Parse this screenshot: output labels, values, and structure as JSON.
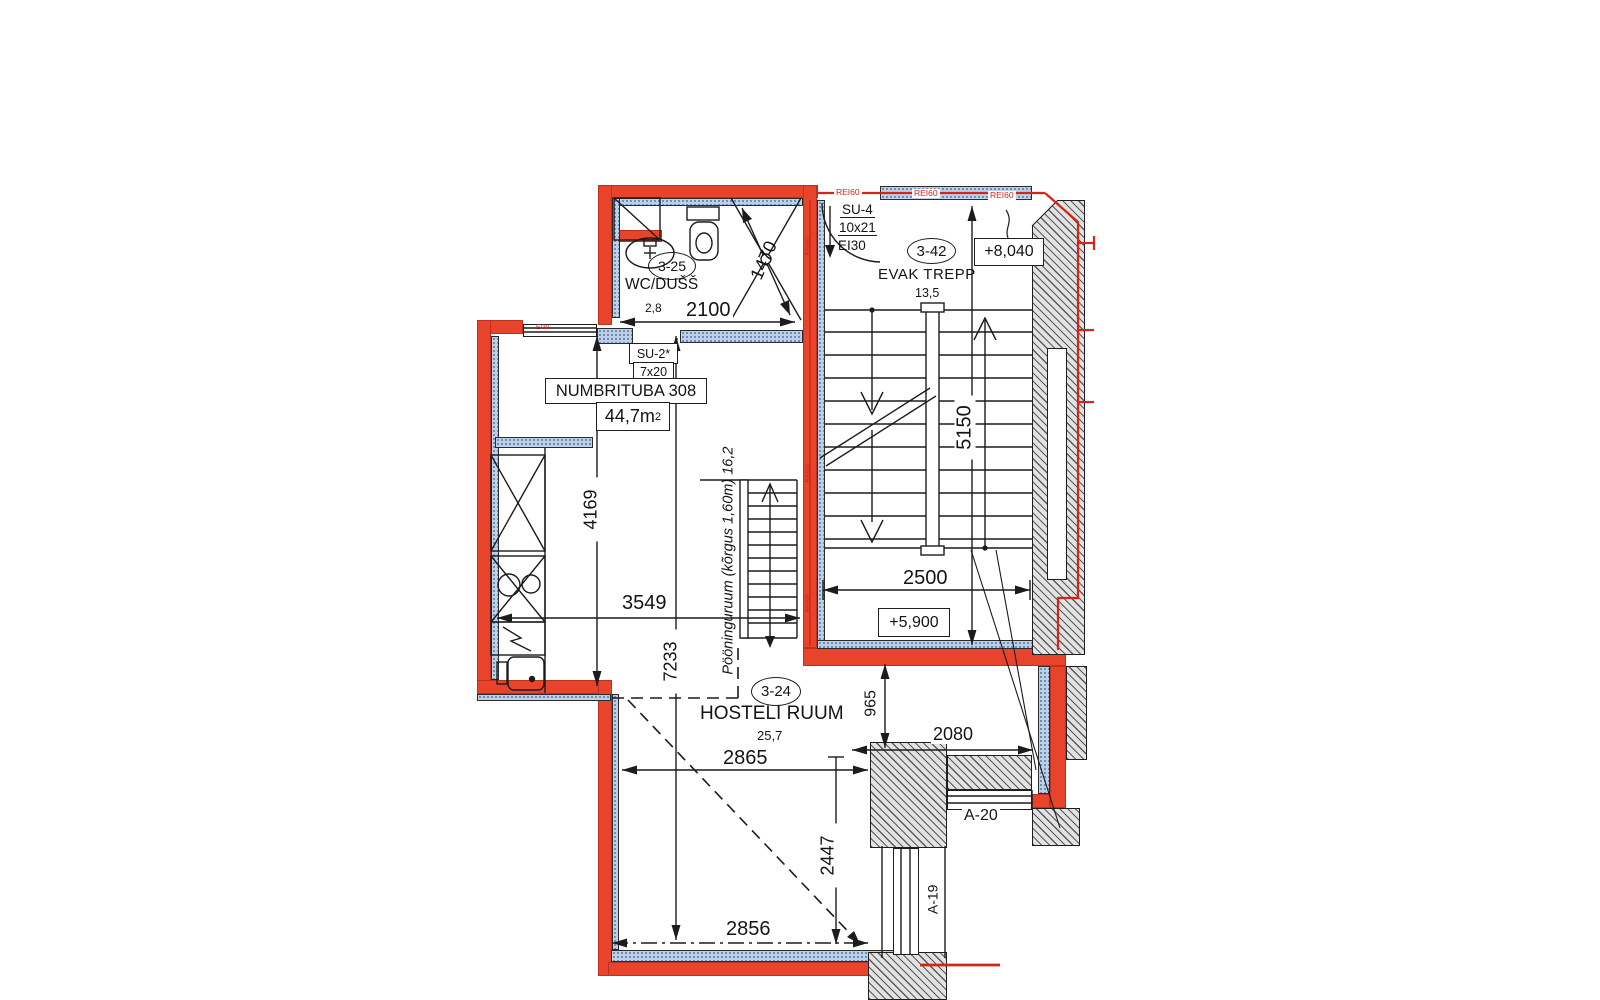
{
  "colors": {
    "wall": "#e8432b",
    "fire": "#d3261a",
    "hatch_blue": "#bcd0ea",
    "hatch_gray": "#e2e2e2",
    "line": "#1c1c1c"
  },
  "rooms": {
    "wc": {
      "id": "3-25",
      "name": "WC/DUŠŠ",
      "area": "2,8"
    },
    "guest": {
      "name": "NUMBRITUBA 308",
      "area_value": "44,7m",
      "area_sup": "2"
    },
    "stair": {
      "id": "3-42",
      "name": "EVAK TREPP",
      "area": "13,5"
    },
    "hostel": {
      "id": "3-24",
      "name": "HOSTELI RUUM",
      "area": "25,7"
    },
    "attic": {
      "note": "Pööninguruum (kõrgus 1,60m) 16,2"
    }
  },
  "doors": {
    "su4": {
      "code": "SU-4",
      "size": "10x21",
      "fire": "EI30"
    },
    "su2": {
      "code": "SU-2*",
      "size": "7x20"
    }
  },
  "windows": {
    "a20": "A-20",
    "a19": "A-19",
    "fire": "EI30"
  },
  "levels": {
    "upper": "+8,040",
    "mid": "+5,900"
  },
  "dims": {
    "d2100": "2100",
    "d1470": "1470",
    "d4169": "4169",
    "d3549": "3549",
    "d7233": "7233",
    "d5150": "5150",
    "d2500": "2500",
    "d2865": "2865",
    "d2856": "2856",
    "d2447": "2447",
    "d965": "965",
    "d2080": "2080"
  },
  "fire": {
    "rei60": "REI60"
  }
}
